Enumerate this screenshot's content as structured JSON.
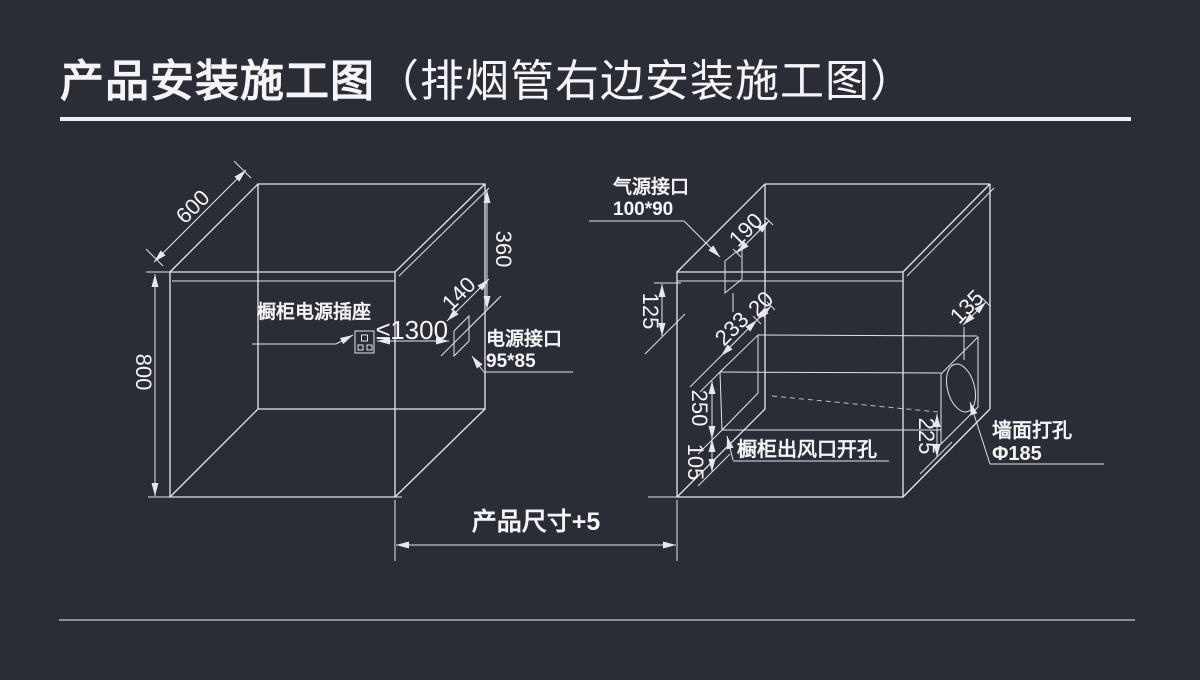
{
  "title": {
    "main": "产品安装施工图",
    "sub": "（排烟管右边安装施工图）"
  },
  "colors": {
    "background": "#2b2d36",
    "line": "#e6e8eb",
    "text": "#f2f4f6",
    "divider": "#8b8f99"
  },
  "left_box": {
    "depth_dim": "600",
    "height_dim": "800",
    "upper_height_dim": "360",
    "port_offset_dim": "140",
    "socket_distance_dim": "≤1300",
    "socket_label": "橱柜电源插座",
    "power_port_label": "电源接口",
    "power_port_size": "95*85"
  },
  "right_box": {
    "gas_port_label": "气源接口",
    "gas_port_size": "100*90",
    "gas_port_offset_dim": "190",
    "top_clearance_dim": "125",
    "duct_depth_dim": "233",
    "duct_gap_dim": "20",
    "duct_top_dim": "250",
    "duct_bottom_dim": "105",
    "vent_cutout_label": "橱柜出风口开孔",
    "wall_hole_offset_dim": "135",
    "wall_hole_height_dim": "225",
    "wall_hole_label": "墙面打孔",
    "wall_hole_diameter": "Φ185"
  },
  "footer": {
    "product_width_dim": "产品尺寸+5"
  }
}
